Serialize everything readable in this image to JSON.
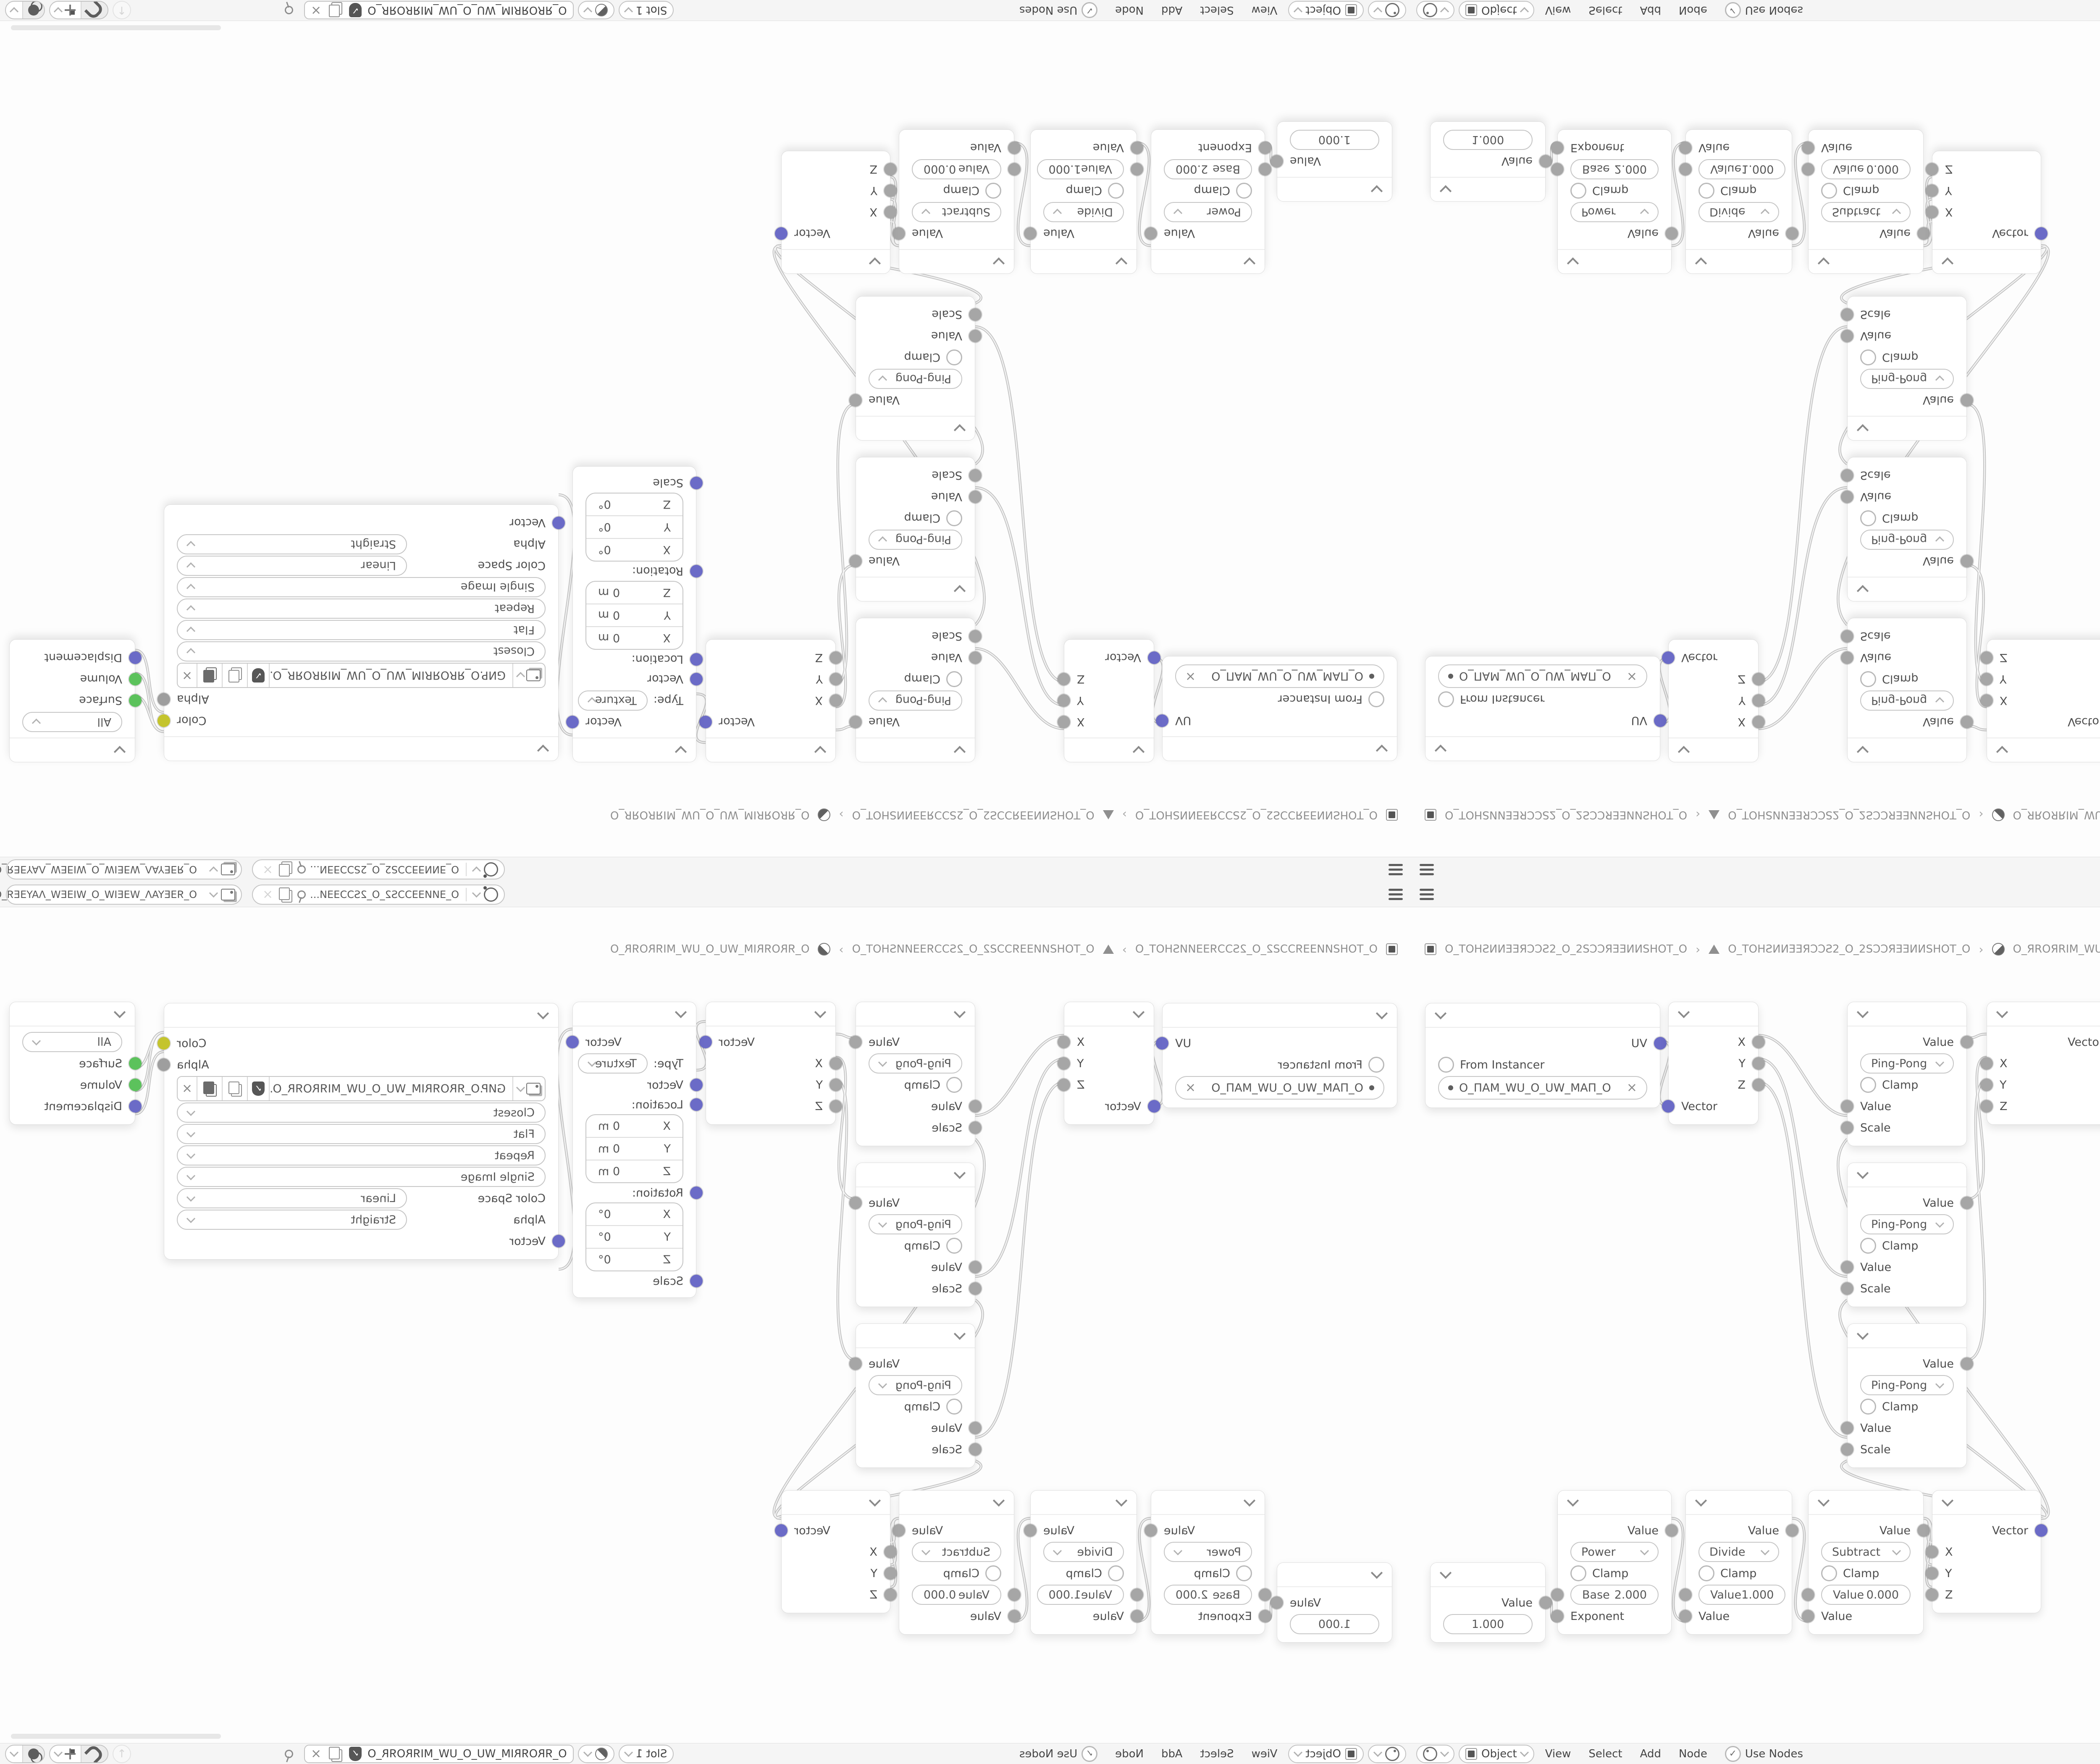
{
  "topbar": {
    "scene_label": "O_ƎИИƎƎƆƆS2_O_2SƆƆƎƎИ...",
    "view_layer_label": "O_ЯƎEYAΛ_WƎEIW_O_WIƎEW_ΛAYƎEЯ_O"
  },
  "breadcrumb": {
    "object_name": "O_TOHƧИИƎƎЯƆƆƧ2_O_2SƆƆЯƎƎИИSHOT_O",
    "mesh_name": "O_TOHƧИИƎƎЯƆƆƧ2_O_2SƆƆЯƎƎИИSHOT_O",
    "material_name": "O_ЯROЯRIM_WU_O_UW_MIЯROЯR_O",
    "separator": "›"
  },
  "header": {
    "mode": "Object",
    "menu_view": "View",
    "menu_select": "Select",
    "menu_add": "Add",
    "menu_node": "Node",
    "use_nodes": "Use Nodes",
    "check": "✓",
    "slot": "Slot 1",
    "tree_name": "O_ЯROЯRIM_WU_O_UW_MIЯROЯR_O",
    "up_arrow": "↑",
    "close_glyph": "×"
  },
  "nodes": {
    "uv": {
      "out": "UV",
      "from_instancer": "From Instancer",
      "map_name": "O_ПAM_WU_O_UW_MAП_O",
      "clear": "×"
    },
    "separate": {
      "x": "X",
      "y": "Y",
      "z": "Z",
      "vector": "Vector"
    },
    "pingpong": {
      "out": "Value",
      "operation": "Ping-Pong",
      "clamp": "Clamp",
      "in_value": "Value",
      "in_scale": "Scale"
    },
    "combine": {
      "out": "Vector",
      "x": "X",
      "y": "Y",
      "z": "Z"
    },
    "mapping": {
      "out": "Vector",
      "type_label": "Type:",
      "type_value": "Texture",
      "in_vector": "Vector",
      "location_label": "Location:",
      "rotation_label": "Rotation:",
      "scale_label": "Scale",
      "axis_x": "X",
      "axis_y": "Y",
      "axis_z": "Z",
      "loc_value": "0 m",
      "rot_value": "0°"
    },
    "image": {
      "out_color": "Color",
      "out_alpha": "Alpha",
      "filename": "GИP.O_ЯROЯRIM_WU_O_UW_MIЯROЯR_O.PNG",
      "interpolation": "Closest",
      "projection": "Flat",
      "extension": "Repeat",
      "source": "Single Image",
      "color_space_label": "Color Space",
      "color_space_value": "Linear",
      "alpha_label": "Alpha",
      "alpha_value": "Straight",
      "in_vector": "Vector",
      "shield_glyph": "✓",
      "close_glyph": "×"
    },
    "output": {
      "target": "All",
      "surface": "Surface",
      "volume": "Volume",
      "displacement": "Displacement"
    },
    "value": {
      "out": "Value",
      "value": "1.000"
    },
    "power": {
      "out": "Value",
      "operation": "Power",
      "clamp": "Clamp",
      "field_label": "Base",
      "field_value": "2.000",
      "in_label": "Exponent"
    },
    "divide": {
      "out": "Value",
      "operation": "Divide",
      "clamp": "Clamp",
      "field_label": "Value",
      "field_value": "1.000",
      "in_label": "Value"
    },
    "subtract": {
      "out": "Value",
      "operation": "Subtract",
      "clamp": "Clamp",
      "field_label": "Value",
      "field_value": "0.000",
      "in_label": "Value"
    }
  },
  "colors": {
    "vector_socket": "#6b6bc7",
    "color_socket": "#c4c42d",
    "shader_socket": "#5cc25c",
    "value_socket": "#a6a6a6"
  }
}
